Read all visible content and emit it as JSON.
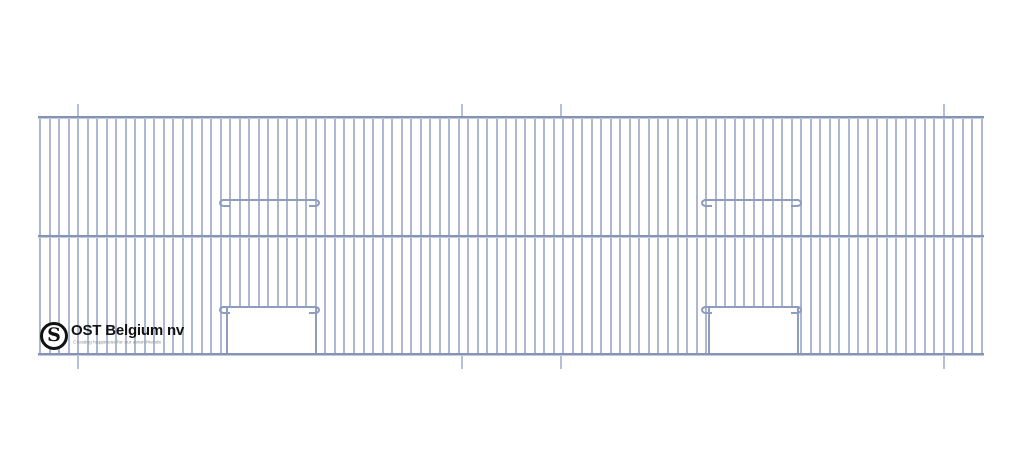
{
  "page": {
    "width": 1024,
    "height": 473,
    "background": "#ffffff"
  },
  "drawing": {
    "type": "cage-front-technical-drawing",
    "colors": {
      "bar": "#adb8ce",
      "rail": "#8593b5",
      "hook_wire": "#8e9cbd",
      "tick": "#b5c0d4",
      "opening_fill": "#ffffff"
    },
    "frame": {
      "left": 38,
      "right": 984,
      "top_rail_y": 116,
      "middle_rail_y": 235,
      "bottom_rail_y": 353
    },
    "bars": {
      "first_x": 40,
      "last_x": 982,
      "count": 100
    },
    "fold_marks": {
      "x_positions": [
        78,
        462,
        561,
        944
      ],
      "top_length": 12,
      "bottom_length": 13
    },
    "doors": [
      {
        "hook_x1": 219,
        "hook_x2": 320,
        "upper_wire_y": 199,
        "lower_wire_y": 306,
        "opening_x1": 227,
        "opening_x2": 316
      },
      {
        "hook_x1": 701,
        "hook_x2": 802,
        "upper_wire_y": 199,
        "lower_wire_y": 306,
        "opening_x1": 709,
        "opening_x2": 798
      }
    ],
    "logo": {
      "monogram": "S",
      "title": "OST Belgium nv",
      "tagline": "Creating happiness for our avian friends",
      "title_color": "#121212",
      "tagline_color": "#8d8d8d"
    }
  }
}
